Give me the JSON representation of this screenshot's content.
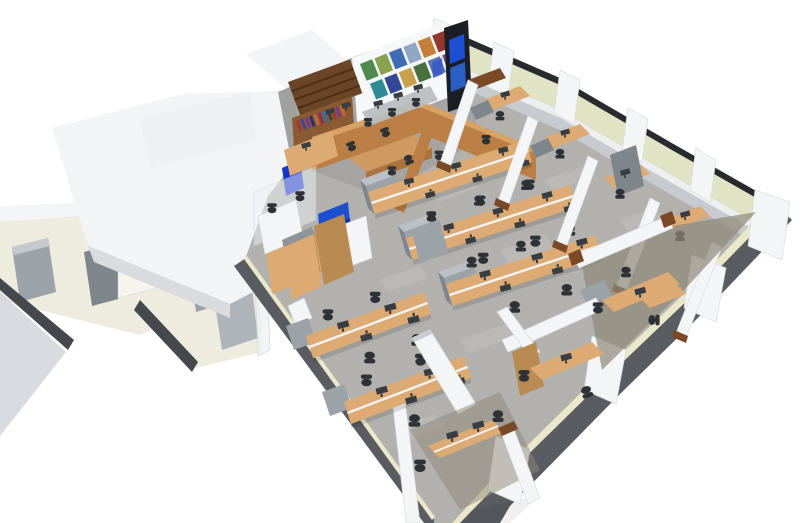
{
  "meta": {
    "title": "3D office floor plan render",
    "description": "Isometric 3D cutaway rendering of an office floor: a reception lounge with a dark-wood bookshelf, colorful poster wall and blue media screens at the top; rows of beech bench desks with monitors and black task chairs on grey carpet tiles in the centre; glazed private offices with pale yellow-green window blinds along the right facade with white columns; restrooms, service rooms and white roof volumes on the left.",
    "style": "architectural visualization, bird's-eye cutaway view"
  },
  "palette": {
    "bg": "#ffffff",
    "roof_top": "#f3f4f6",
    "roof_side": "#e8eaed",
    "roof_edge": "#d9dbdf",
    "tile": "#edecdf",
    "wall_white": "#f4f5f6",
    "plane_gray": "#ced2d7",
    "edge_dark": "#45484c",
    "carpet": "#b2b1ae",
    "carpet_light": "#c6c4c1",
    "concrete": "#a0a09e",
    "carpet_brown": "#8f8778",
    "facade_band": "#595d62",
    "facade_cream": "#eae7cb",
    "window_frame": "#282b2e",
    "blind": "#e0e4c5",
    "sill": "#eceeef",
    "base_gray": "#c7cbcf",
    "wood_dark": "#6b4527",
    "wood_shelf": "#8a5a32",
    "wood_mid": "#bb7e44",
    "wood_mid_top": "#d9a263",
    "wood_beech": "#dcaa72",
    "wood_beech_dark": "#b98a52",
    "wood_trim": "#7a4a28",
    "cabinet_gray": "#9ba3a9",
    "cabinet_gray_top": "#bac0c5",
    "cabinet_gray_dark": "#7e868c",
    "monitor": "#383d42",
    "chair": "#2e3236",
    "screen_blue": "#1d4fd2",
    "screen_blue2": "#2e66d8",
    "screen_navy": "#0c2d7e",
    "accent_navy": "#1733c8",
    "glass": "#eef3f6"
  },
  "scene": {
    "areas": [
      "reception-lounge",
      "open-plan-workspace",
      "private-offices",
      "restrooms",
      "service-rooms"
    ],
    "reception": {
      "poster_colors": [
        "#4f8a4e",
        "#8aa24f",
        "#3f6db2",
        "#8fa6c4",
        "#c57f3b",
        "#93372e",
        "#2f8c96",
        "#32499a",
        "#c8a14a",
        "#49713f",
        "#5a76b6",
        "#884a8e"
      ],
      "book_colors": [
        "#a03636",
        "#3a4a9a",
        "#7a3a92",
        "#24307e",
        "#c06a32",
        "#8c2f4f",
        "#2f6fae",
        "#5a3a24"
      ],
      "screen_panel_colors": [
        "#1d4fd2",
        "#2e66d8"
      ]
    },
    "open_plan": {
      "bench_rows": 5,
      "workstations_approx": 26
    },
    "private_offices": {
      "along_top_facade": 4,
      "along_lower_facade": 3
    },
    "facade": {
      "window_bays": 4,
      "columns_top": 5,
      "columns_lower": 4
    }
  }
}
